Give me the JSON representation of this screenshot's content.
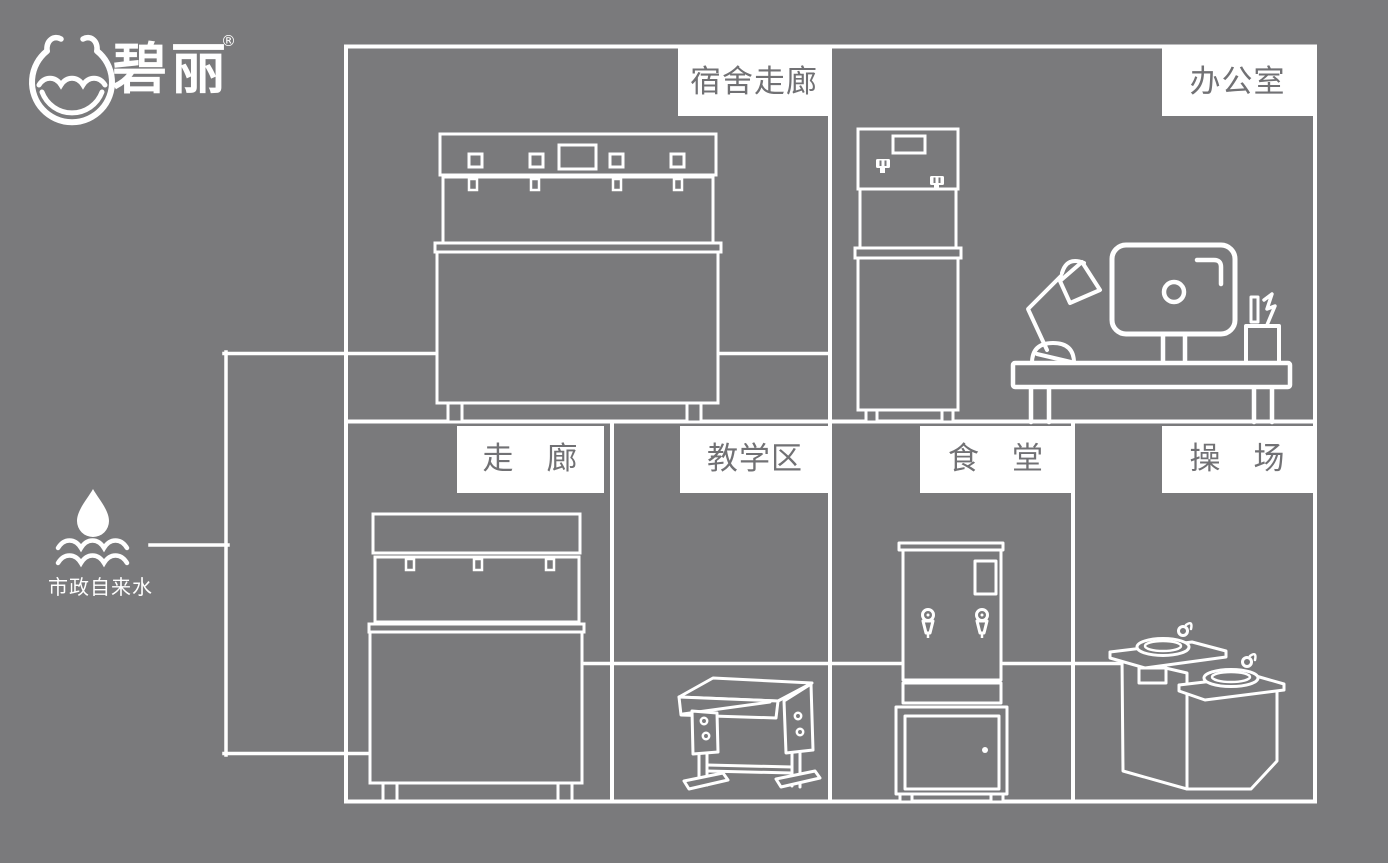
{
  "colors": {
    "background": "#7a7a7c",
    "line_art": "#ffffff",
    "label_box_bg": "#ffffff",
    "label_text": "#717174"
  },
  "logo": {
    "brand": "碧丽",
    "registered_mark": "®",
    "icon": "water-cup-logo-mark"
  },
  "water_source": {
    "label": "市政自来水",
    "icon": "water-drop-with-waves-icon"
  },
  "room_labels": {
    "dorm_corridor": "宿舍走廊",
    "office": "办公室",
    "corridor": "走　廊",
    "teaching_area": "教学区",
    "canteen": "食　堂",
    "playground": "操　场"
  },
  "equipment_icons": [
    "dorm-corridor-multi-tap-dispenser",
    "office-cabinet-dispenser",
    "office-desk-with-monitor-and-lamp",
    "classroom-desk",
    "canteen-water-boiler",
    "playground-two-tier-drinking-fountain"
  ]
}
